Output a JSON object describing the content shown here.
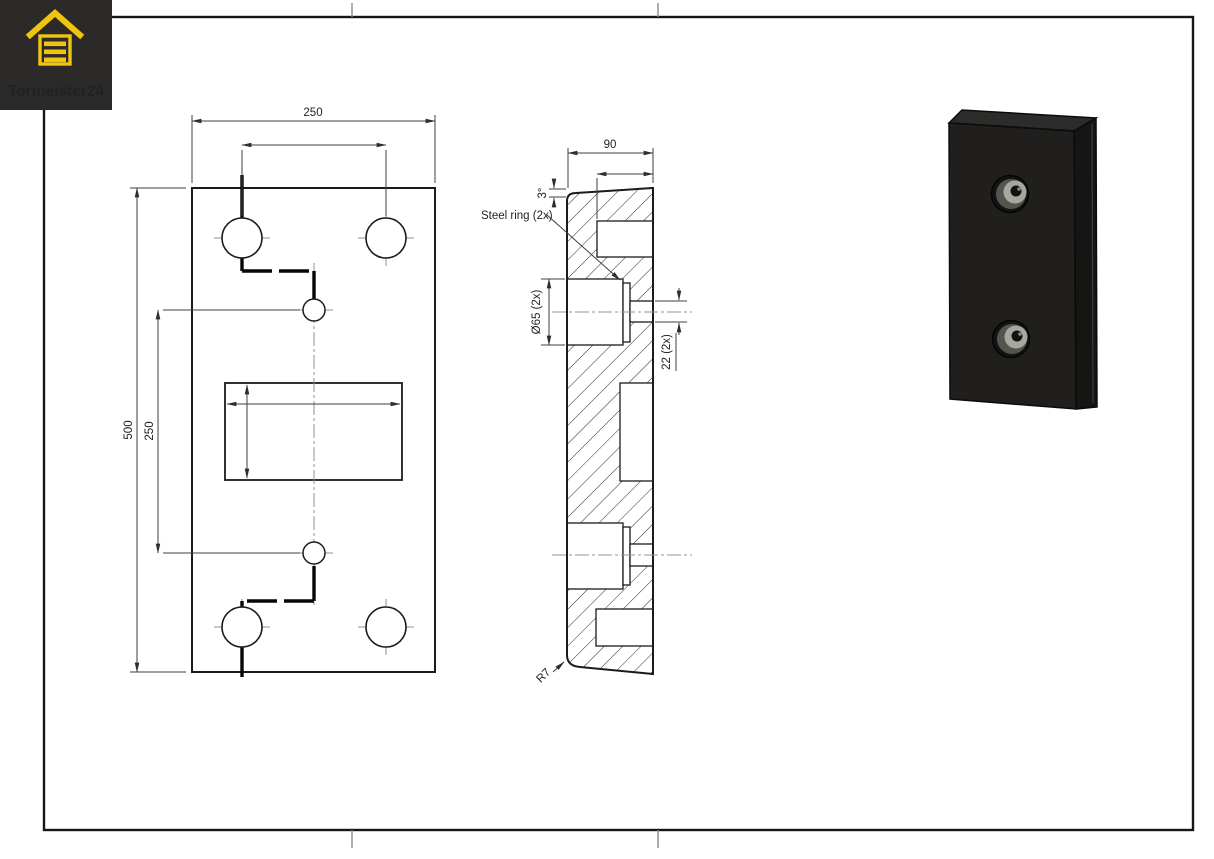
{
  "logo": {
    "brand": "Tormeister24",
    "background_color": "#2b2a28",
    "accent_color": "#f1c40f",
    "icon": "garage-door-icon"
  },
  "sheet": {
    "background_color": "#ffffff",
    "frame_color": "#161616",
    "tick_color": "#8a8a8a"
  },
  "front_view": {
    "dim_width_top": "250",
    "dim_height_left": "500",
    "dim_hole_distance_left": "250"
  },
  "section_view": {
    "dim_depth_top": "90",
    "dim_draft_angle": "3°",
    "label_steel_ring": "Steel ring (2x)",
    "dim_ring_diameter": "Ø65 (2x)",
    "dim_through_hole": "22 (2x)",
    "dim_corner_radius": "R7"
  },
  "render_3d": {
    "front_face_color": "#201f1d",
    "side_face_color": "#151513",
    "top_face_color": "#2c2c2a",
    "recess_floor_color": "#a8a79f",
    "recess_wall_color": "#55544c"
  }
}
